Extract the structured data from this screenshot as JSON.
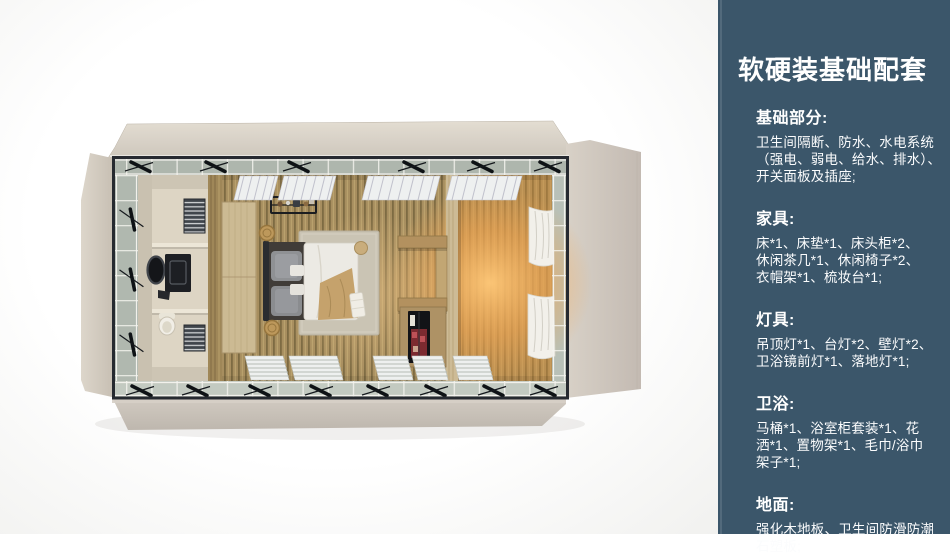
{
  "panel": {
    "title": "软硬装基础配套",
    "bg_color": "#3b566a",
    "text_color": "#ffffff",
    "sections": [
      {
        "id": "basics",
        "heading": "基础部分:",
        "lines": [
          "卫生间隔断、防水、水电系统",
          "（强电、弱电、给水、排水）、",
          "开关面板及插座;"
        ]
      },
      {
        "id": "furniture",
        "heading": "家具:",
        "lines": [
          "床*1、床垫*1、床头柜*2、",
          "休闲茶几*1、休闲椅子*2、",
          "衣帽架*1、梳妆台*1;"
        ]
      },
      {
        "id": "lighting",
        "heading": "灯具:",
        "lines": [
          "吊顶灯*1、台灯*2、壁灯*2、",
          "卫浴镜前灯*1、落地灯*1;"
        ]
      },
      {
        "id": "bathroom",
        "heading": "卫浴:",
        "lines": [
          "马桶*1、浴室柜套装*1、花",
          "洒*1、置物架*1、毛巾/浴巾",
          "架子*1;"
        ]
      },
      {
        "id": "flooring",
        "heading": "地面:",
        "lines": [
          "强化木地板、卫生间防滑防潮",
          "石塑板;"
        ]
      }
    ]
  },
  "illustration": {
    "colors": {
      "flap_beige": "#d5cec4",
      "frame_dark": "#262a30",
      "glass": "#b2bab1",
      "wood_floor": "#a78e5f",
      "warm_glow": "#f0a95c",
      "rug": "#cac4b4",
      "duvet": "#e9e6df",
      "blanket_tan": "#c5a26c"
    }
  }
}
